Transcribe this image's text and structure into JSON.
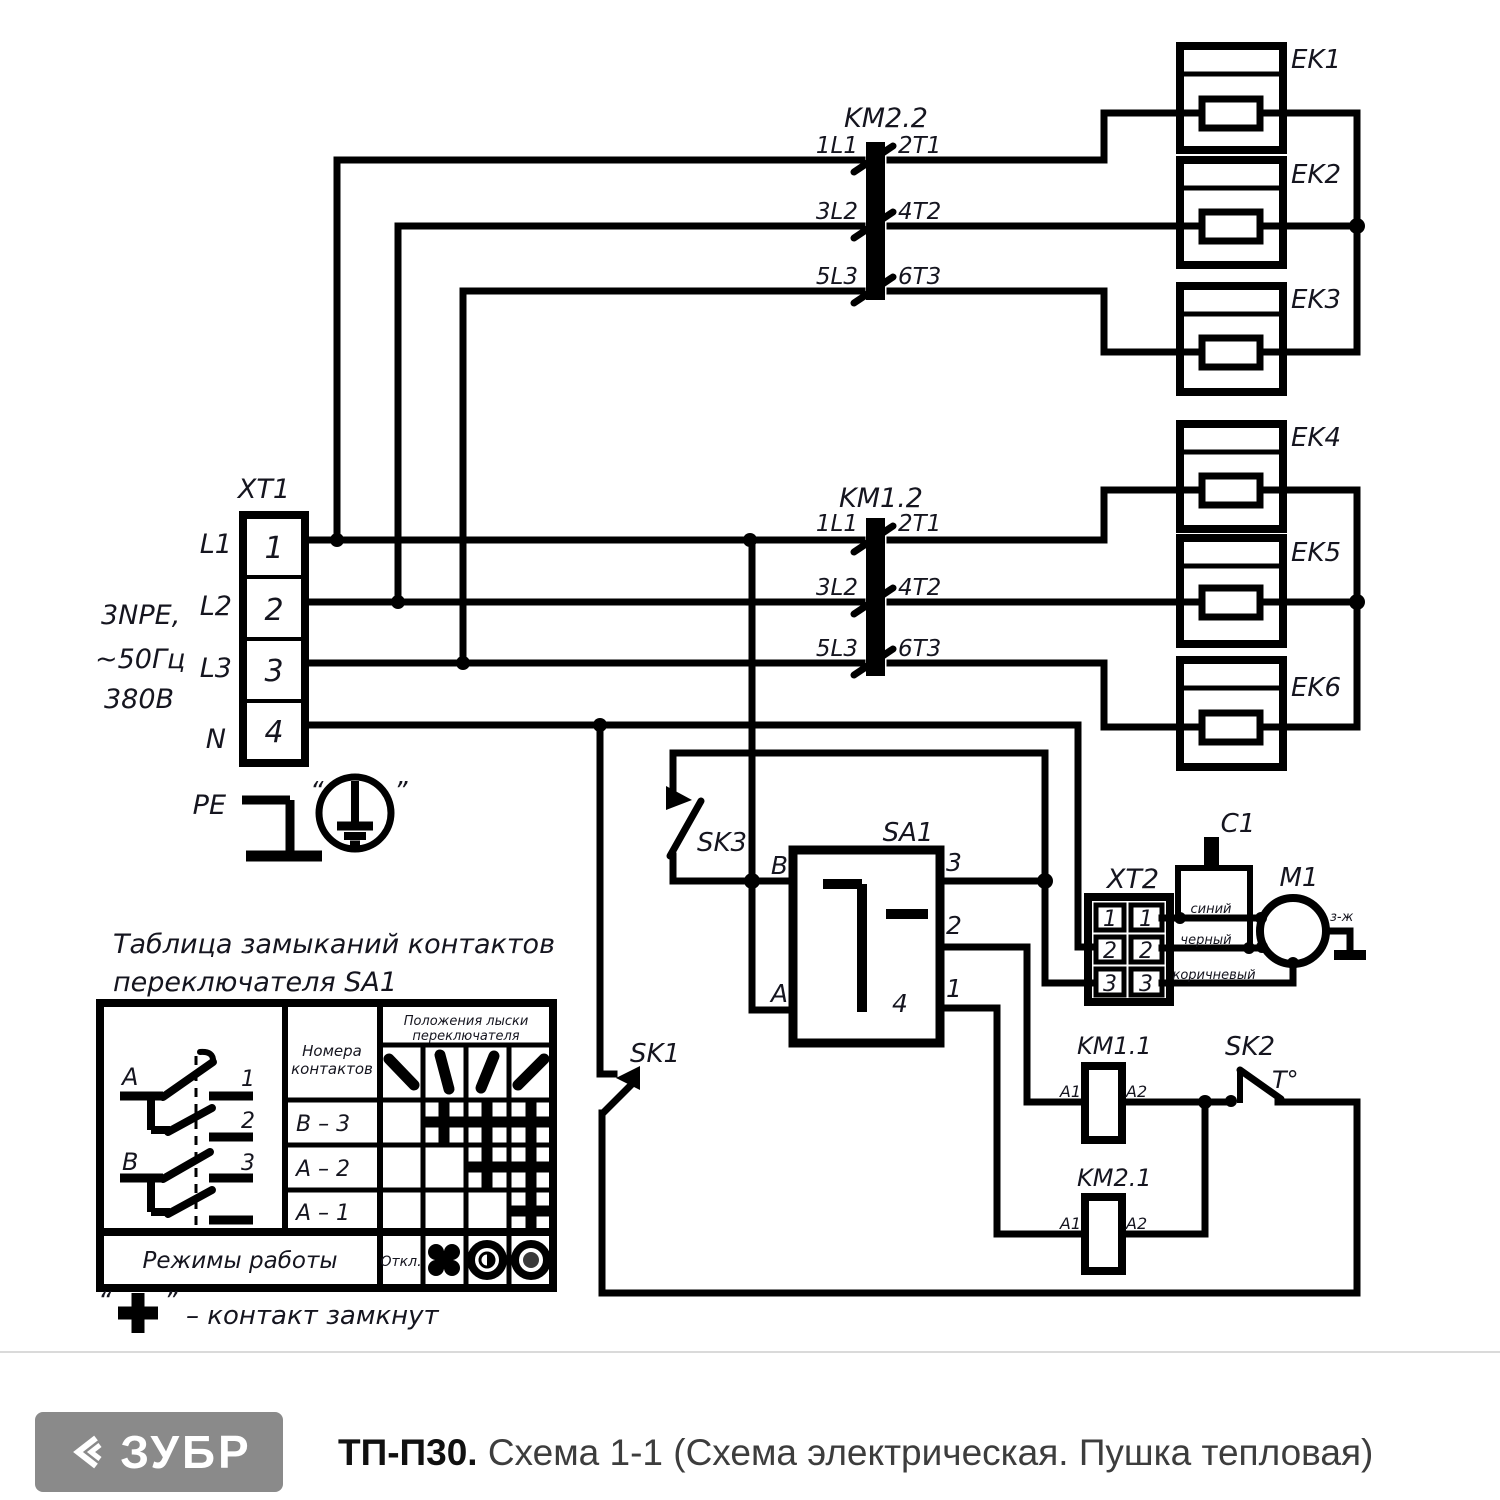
{
  "schematic": {
    "xt1": {
      "label": "XT1",
      "pe": "PE",
      "rows": [
        {
          "line": "L1",
          "terminal": "1"
        },
        {
          "line": "L2",
          "terminal": "2"
        },
        {
          "line": "L3",
          "terminal": "3"
        },
        {
          "line": "N",
          "terminal": "4"
        }
      ],
      "supply": [
        "3NPE,",
        "~50Гц",
        "380В"
      ],
      "ground_quote_open": "“",
      "ground_quote_close": "”"
    },
    "km22": {
      "label": "KM2.2",
      "poles": [
        {
          "in": "1L1",
          "out": "2T1"
        },
        {
          "in": "3L2",
          "out": "4T2"
        },
        {
          "in": "5L3",
          "out": "6T3"
        }
      ]
    },
    "km12": {
      "label": "KM1.2",
      "poles": [
        {
          "in": "1L1",
          "out": "2T1"
        },
        {
          "in": "3L2",
          "out": "4T2"
        },
        {
          "in": "5L3",
          "out": "6T3"
        }
      ]
    },
    "heaters": [
      {
        "label": "EK1"
      },
      {
        "label": "EK2"
      },
      {
        "label": "EK3"
      },
      {
        "label": "EK4"
      },
      {
        "label": "EK5"
      },
      {
        "label": "EK6"
      }
    ],
    "sk1": "SK1",
    "sk2": "SK2",
    "sk2_temp": "T°",
    "sk3": "SK3",
    "sa1": {
      "label": "SA1",
      "b": "B",
      "a": "A",
      "t1": "1",
      "t2": "2",
      "t3": "3",
      "t4": "4"
    },
    "xt2": {
      "label": "XT2",
      "left": [
        "1",
        "2",
        "3"
      ],
      "right": [
        "1",
        "2",
        "3"
      ]
    },
    "c1": "C1",
    "m1": "M1",
    "ground_wire": "з-ж",
    "wires": {
      "blue": "синий",
      "black": "черный",
      "brown": "коричневый"
    },
    "km11": {
      "label": "KM1.1",
      "a1": "A1",
      "a2": "A2"
    },
    "km21": {
      "label": "KM2.1",
      "a1": "A1",
      "a2": "A2"
    }
  },
  "table": {
    "title_line1": "Таблица замыканий контактов",
    "title_line2": "переключателя SA1",
    "col_contacts_line1": "Номера",
    "col_contacts_line2": "контактов",
    "col_positions_line1": "Положения лыски",
    "col_positions_line2": "переключателя",
    "rows": [
      {
        "label": "B – 3",
        "closed_positions": [
          2,
          3,
          4
        ]
      },
      {
        "label": "A – 2",
        "closed_positions": [
          3,
          4
        ]
      },
      {
        "label": "A – 1",
        "closed_positions": [
          4
        ]
      }
    ],
    "modes_label": "Режимы работы",
    "mode_off": "Откл.",
    "diagram": {
      "a": "A",
      "b": "B",
      "c1": "1",
      "c2": "2",
      "c3": "3"
    }
  },
  "legend": {
    "symbol": "+",
    "text": "– контакт замкнут",
    "quote_open": "“",
    "quote_close": "”"
  },
  "footer": {
    "brand": "ЗУБР",
    "model": "ТП-П30.",
    "title": "Схема 1-1 (Схема электрическая. Пушка тепловая)"
  }
}
